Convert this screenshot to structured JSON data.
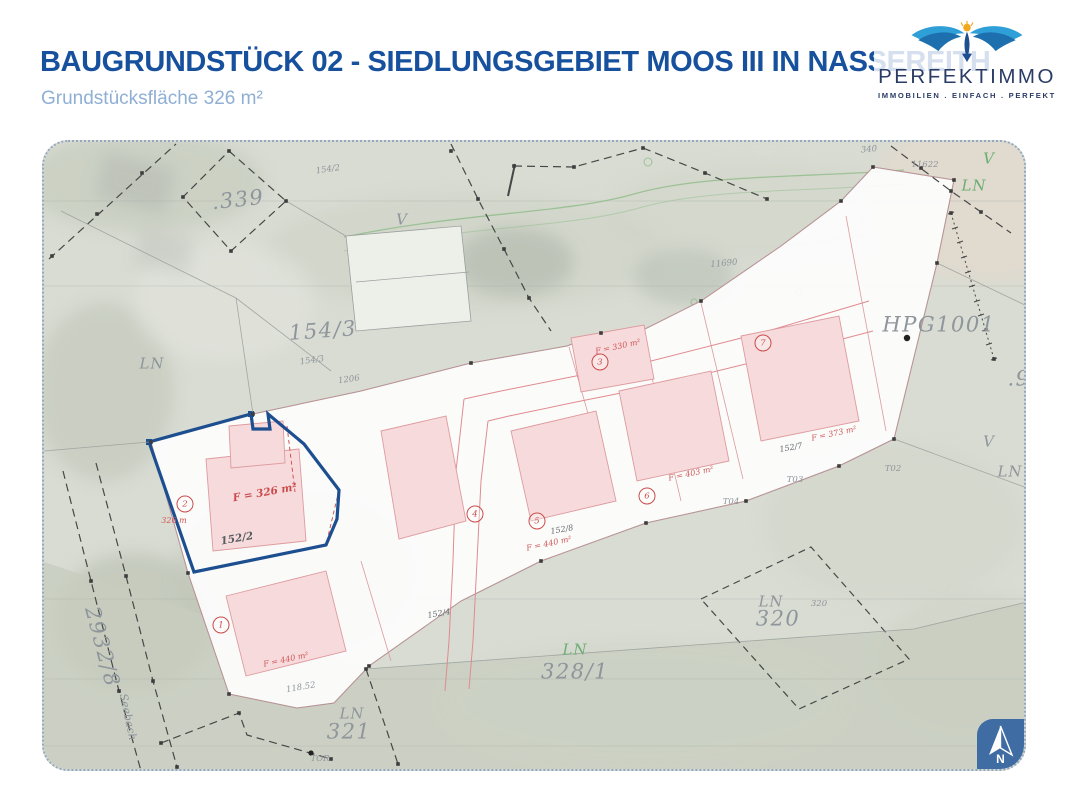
{
  "header": {
    "title_prefix": "BAUGRUNDSTÜCK",
    "title_main": " 02 - SIEDLUNGSGEBIET MOOS III IN NASSEREITH",
    "subtitle": "Grundstücksfläche 326 m²"
  },
  "logo": {
    "brand": "PERFEKTIMMO",
    "tagline": "IMMOBILIEN . EINFACH . PERFEKT",
    "colors": {
      "wing_blue": "#2f9fd8",
      "wing_navy": "#1d6fae",
      "sun_gold": "#f2a71f",
      "text_navy": "#2a3b66"
    }
  },
  "compass": {
    "label": "N",
    "box_color": "#3f6da3"
  },
  "colors": {
    "title_blue": "#17519e",
    "subtitle_blue": "#8fafd5",
    "highlight_plot_outline": "#1d4e8f",
    "cadastral_red": "#c94b4b",
    "parcel_pink": "#de9b9e",
    "label_gray": "#8e959b",
    "label_green": "#6aae72",
    "map_background": "#d9dcd3"
  },
  "map": {
    "labels": [
      {
        "t": ".339",
        "x": 194,
        "y": 58,
        "c": "g-lg",
        "r": -6
      },
      {
        "t": "154/2",
        "x": 284,
        "y": 28,
        "c": "g-xs",
        "r": -8
      },
      {
        "t": "V",
        "x": 358,
        "y": 78,
        "c": "g-md",
        "r": 0
      },
      {
        "t": "154/3",
        "x": 279,
        "y": 189,
        "c": "g-lg",
        "r": -4
      },
      {
        "t": "154/3",
        "x": 268,
        "y": 219,
        "c": "g-xs",
        "r": -8
      },
      {
        "t": "LN",
        "x": 108,
        "y": 222,
        "c": "g-md",
        "r": 0
      },
      {
        "t": "1206",
        "x": 305,
        "y": 238,
        "c": "g-xs",
        "r": -8
      },
      {
        "t": "11690",
        "x": 680,
        "y": 122,
        "c": "g-xs",
        "r": -5
      },
      {
        "t": "HPG1001",
        "x": 895,
        "y": 183,
        "c": "g-lg",
        "r": 0
      },
      {
        "t": "11622",
        "x": 881,
        "y": 23,
        "c": "g-xs",
        "r": 0
      },
      {
        "t": "340",
        "x": 825,
        "y": 8,
        "c": "g-xs",
        "r": -5
      },
      {
        "t": "V",
        "x": 945,
        "y": 17,
        "c": "g-md grn",
        "r": 0
      },
      {
        "t": "LN",
        "x": 930,
        "y": 44,
        "c": "g-md grn",
        "r": 0
      },
      {
        "t": ".9",
        "x": 975,
        "y": 237,
        "c": "g-lg",
        "r": 0
      },
      {
        "t": "V",
        "x": 945,
        "y": 300,
        "c": "g-md",
        "r": 0
      },
      {
        "t": "LN",
        "x": 966,
        "y": 330,
        "c": "g-md",
        "r": 0
      },
      {
        "t": "LN",
        "x": 727,
        "y": 460,
        "c": "g-md",
        "r": 0
      },
      {
        "t": "320",
        "x": 734,
        "y": 477,
        "c": "g-lg",
        "r": 0
      },
      {
        "t": "320",
        "x": 775,
        "y": 462,
        "c": "g-xs",
        "r": 0
      },
      {
        "t": "LN",
        "x": 531,
        "y": 508,
        "c": "g-md grn",
        "r": 0
      },
      {
        "t": "328/1",
        "x": 531,
        "y": 530,
        "c": "g-lg",
        "r": 0
      },
      {
        "t": "LN",
        "x": 308,
        "y": 572,
        "c": "g-md",
        "r": 0
      },
      {
        "t": "321",
        "x": 305,
        "y": 590,
        "c": "g-lg",
        "r": 0
      },
      {
        "t": "TOR",
        "x": 276,
        "y": 617,
        "c": "g-xs",
        "r": 0
      },
      {
        "t": "2932/8",
        "x": 58,
        "y": 505,
        "c": "g-lg",
        "r": 75
      },
      {
        "t": "Seebach",
        "x": 84,
        "y": 575,
        "c": "g-sm",
        "r": 78
      },
      {
        "t": "118.52",
        "x": 257,
        "y": 546,
        "c": "g-xs",
        "r": -10
      },
      {
        "t": "152/2",
        "x": 193,
        "y": 397,
        "c": "dk",
        "r": -10
      },
      {
        "t": "152/4",
        "x": 395,
        "y": 472,
        "c": "xs-dk",
        "r": -10
      },
      {
        "t": "152/8",
        "x": 518,
        "y": 388,
        "c": "xs-dk",
        "r": -10
      },
      {
        "t": "152/7",
        "x": 747,
        "y": 306,
        "c": "xs-dk",
        "r": -10
      },
      {
        "t": "T02",
        "x": 849,
        "y": 327,
        "c": "g-xs",
        "r": 0
      },
      {
        "t": "T03",
        "x": 751,
        "y": 338,
        "c": "g-xs",
        "r": 0
      },
      {
        "t": "T04",
        "x": 687,
        "y": 360,
        "c": "g-xs",
        "r": 0
      },
      {
        "t": "F = 326 m²",
        "x": 221,
        "y": 351,
        "c": "red-md",
        "r": -10
      },
      {
        "t": "326 m",
        "x": 130,
        "y": 379,
        "c": "red-xs",
        "r": 0
      },
      {
        "t": "F = 330 m²",
        "x": 574,
        "y": 205,
        "c": "red-xs",
        "r": -12
      },
      {
        "t": "F = 440 m²",
        "x": 505,
        "y": 402,
        "c": "red-xs",
        "r": -12
      },
      {
        "t": "F = 403 m²",
        "x": 647,
        "y": 332,
        "c": "red-xs",
        "r": -12
      },
      {
        "t": "F = 373 m²",
        "x": 790,
        "y": 292,
        "c": "red-xs",
        "r": -12
      },
      {
        "t": "F = 440 m²",
        "x": 242,
        "y": 518,
        "c": "red-xs",
        "r": -12
      }
    ],
    "plot_circles": [
      {
        "n": "1",
        "x": 177,
        "y": 483
      },
      {
        "n": "2",
        "x": 141,
        "y": 362
      },
      {
        "n": "3",
        "x": 556,
        "y": 220
      },
      {
        "n": "4",
        "x": 431,
        "y": 372
      },
      {
        "n": "5",
        "x": 493,
        "y": 379
      },
      {
        "n": "6",
        "x": 603,
        "y": 354
      },
      {
        "n": "7",
        "x": 719,
        "y": 201
      }
    ]
  }
}
